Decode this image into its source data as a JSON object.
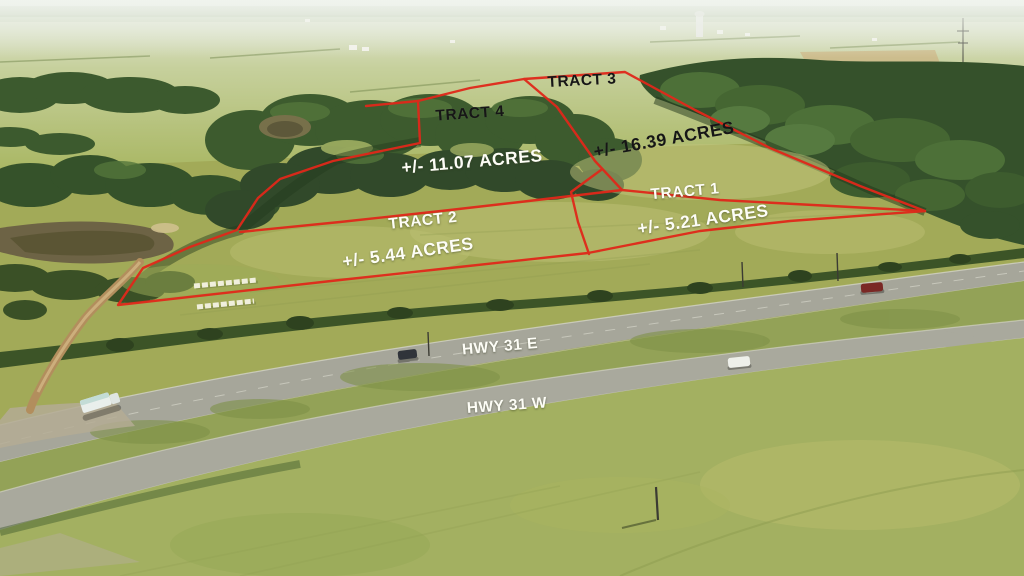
{
  "image_type": "aerial-property-listing-photo",
  "tracts": [
    {
      "name": "TRACT 1",
      "acreage": "+/- 5.21 ACRES"
    },
    {
      "name": "TRACT 2",
      "acreage": "+/- 5.44 ACRES"
    },
    {
      "name": "TRACT 3",
      "acreage": "+/- 16.39 ACRES"
    },
    {
      "name": "TRACT 4",
      "acreage": "+/- 11.07 ACRES"
    }
  ],
  "highways": {
    "east": "HWY 31 E",
    "west": "HWY 31 W"
  },
  "colors": {
    "boundary_red": "#e0281a",
    "label_white": "#fdfdf6",
    "label_dark": "#161616"
  }
}
